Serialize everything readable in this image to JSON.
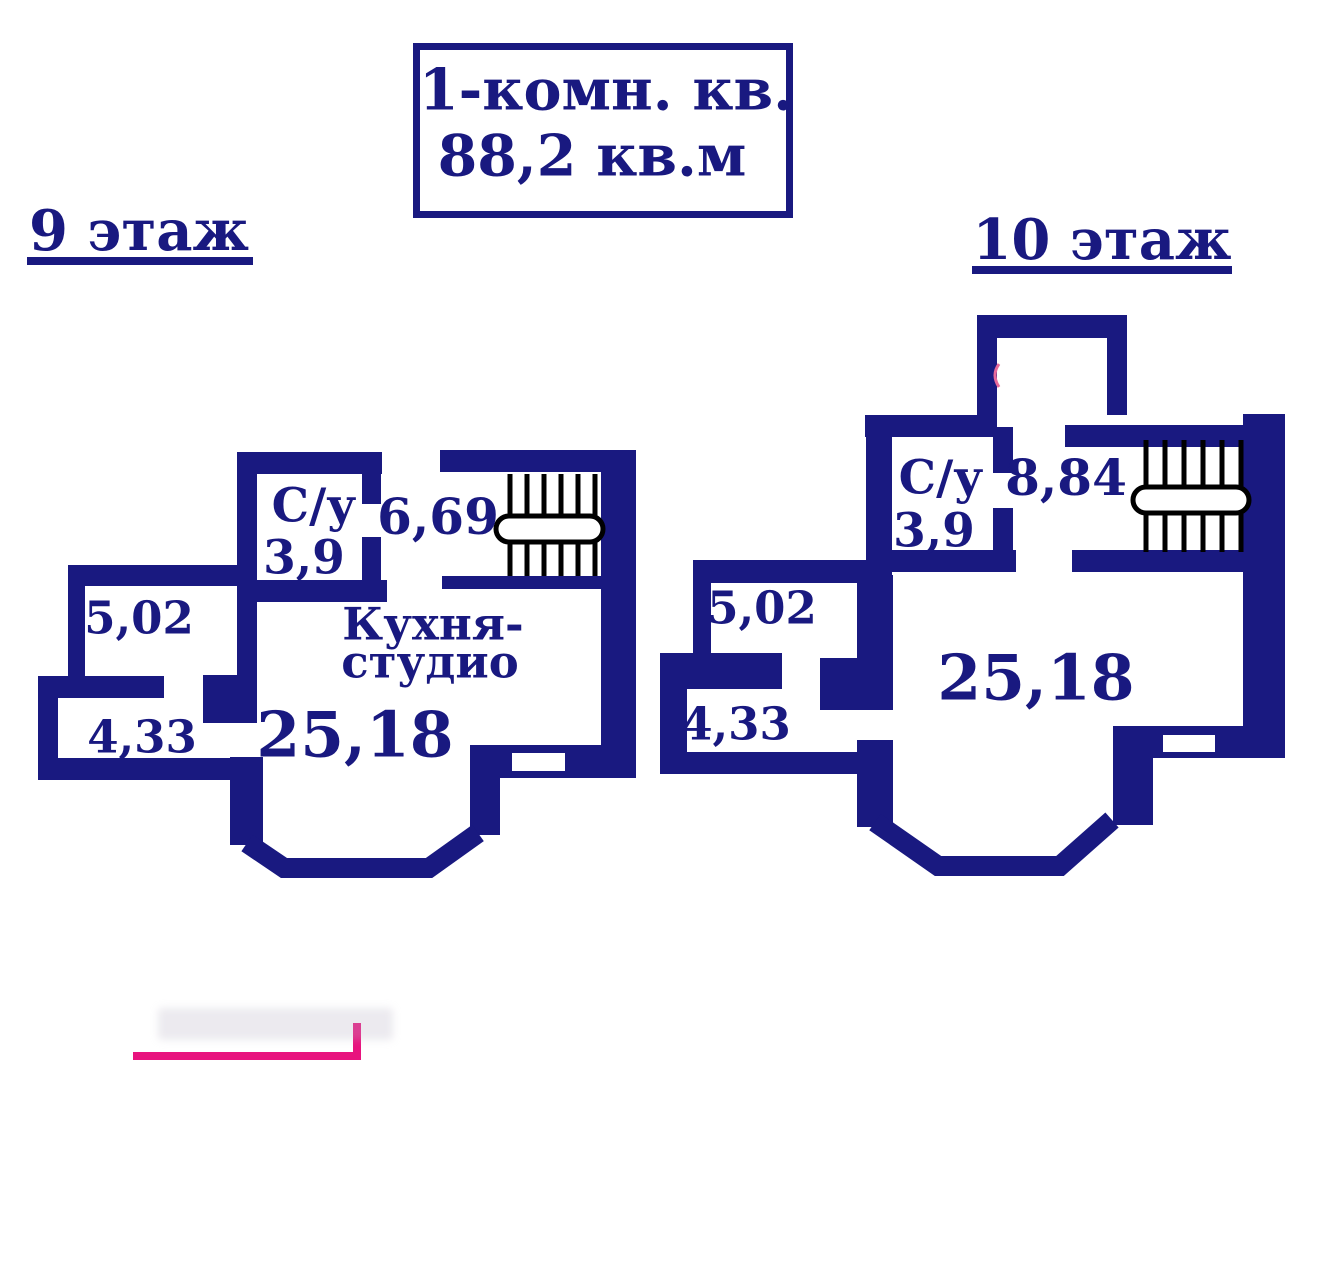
{
  "title_box": {
    "line1": "1-комн. кв.",
    "line2": "88,2 кв.м"
  },
  "floor9": {
    "label": "9 этаж",
    "bathroom_label": "С/у",
    "bathroom_area": "3,9",
    "hall_area": "6,69",
    "loggia_upper_area": "5,02",
    "loggia_lower_area": "4,33",
    "kitchen_label_line1": "Кухня-",
    "kitchen_label_line2": "студио",
    "kitchen_area": "25,18"
  },
  "floor10": {
    "label": "10 этаж",
    "bathroom_label": "С/у",
    "bathroom_area": "3,9",
    "hall_area": "8,84",
    "loggia_upper_area": "5,02",
    "loggia_lower_area": "4,33",
    "main_room_area": "25,18"
  },
  "colors": {
    "wall_navy": "#191980",
    "text_navy": "#191980",
    "stairs_black": "#000000",
    "accent_pink": "#e8137e"
  }
}
